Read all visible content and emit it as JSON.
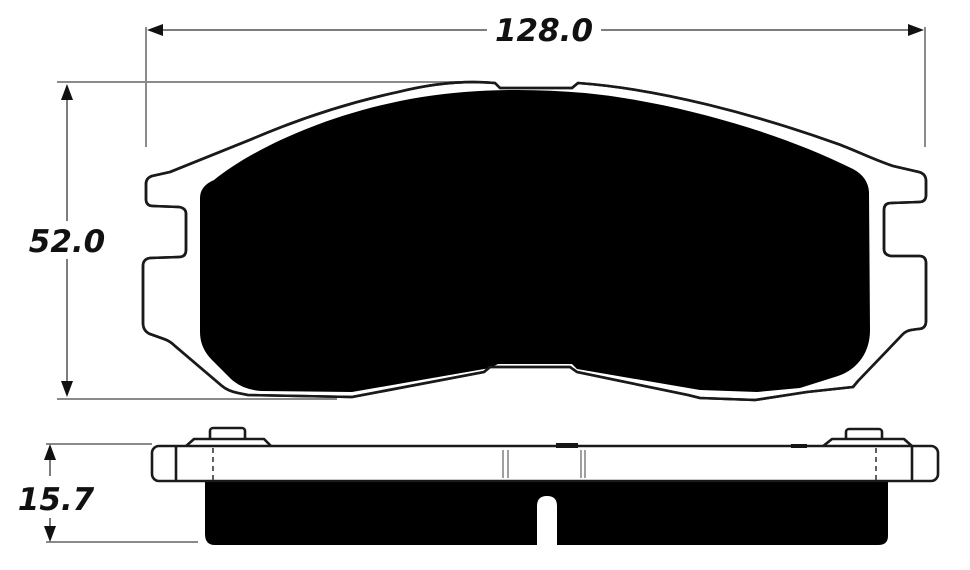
{
  "drawing": {
    "type": "technical-drawing",
    "subject": "brake-pad",
    "views": {
      "front": {
        "width_label": "128.0",
        "height_label": "52.0"
      },
      "side": {
        "thickness_label": "15.7"
      }
    },
    "colors": {
      "outline": "#1a1a1a",
      "dim_line": "#7d7d7d",
      "friction_fill": "#000000",
      "plate_fill": "#ffffff",
      "background": "#ffffff",
      "text": "#111111"
    }
  }
}
